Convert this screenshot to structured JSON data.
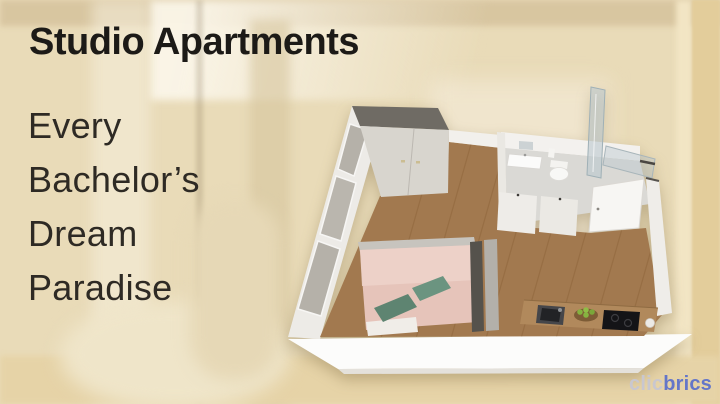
{
  "page": {
    "title": "Studio Apartments",
    "subtitle_lines": [
      "Every",
      "Bachelor’s",
      "Dream",
      "Paradise"
    ]
  },
  "logo": {
    "prefix": "clic",
    "suffix": "brics"
  },
  "floorplan": {
    "label": "3D isometric cutaway floor plan of a studio apartment with bed area, wardrobe, bathroom and kitchen"
  },
  "colors": {
    "background_beige": "#e9dbb8",
    "title_text": "#1c1a17",
    "subtitle_text": "#2e2a24",
    "logo_gray": "#c9c7cf",
    "logo_blue": "#6476c8",
    "floor_wood": "#a2794f",
    "wall_white": "#f2f0ec",
    "wardrobe_gray": "#d8d5ce",
    "bed_pink": "#e6c4ba",
    "pillow_teal": "#5e8471",
    "counter_wood": "#b1895c",
    "cooktop_black": "#141417"
  }
}
